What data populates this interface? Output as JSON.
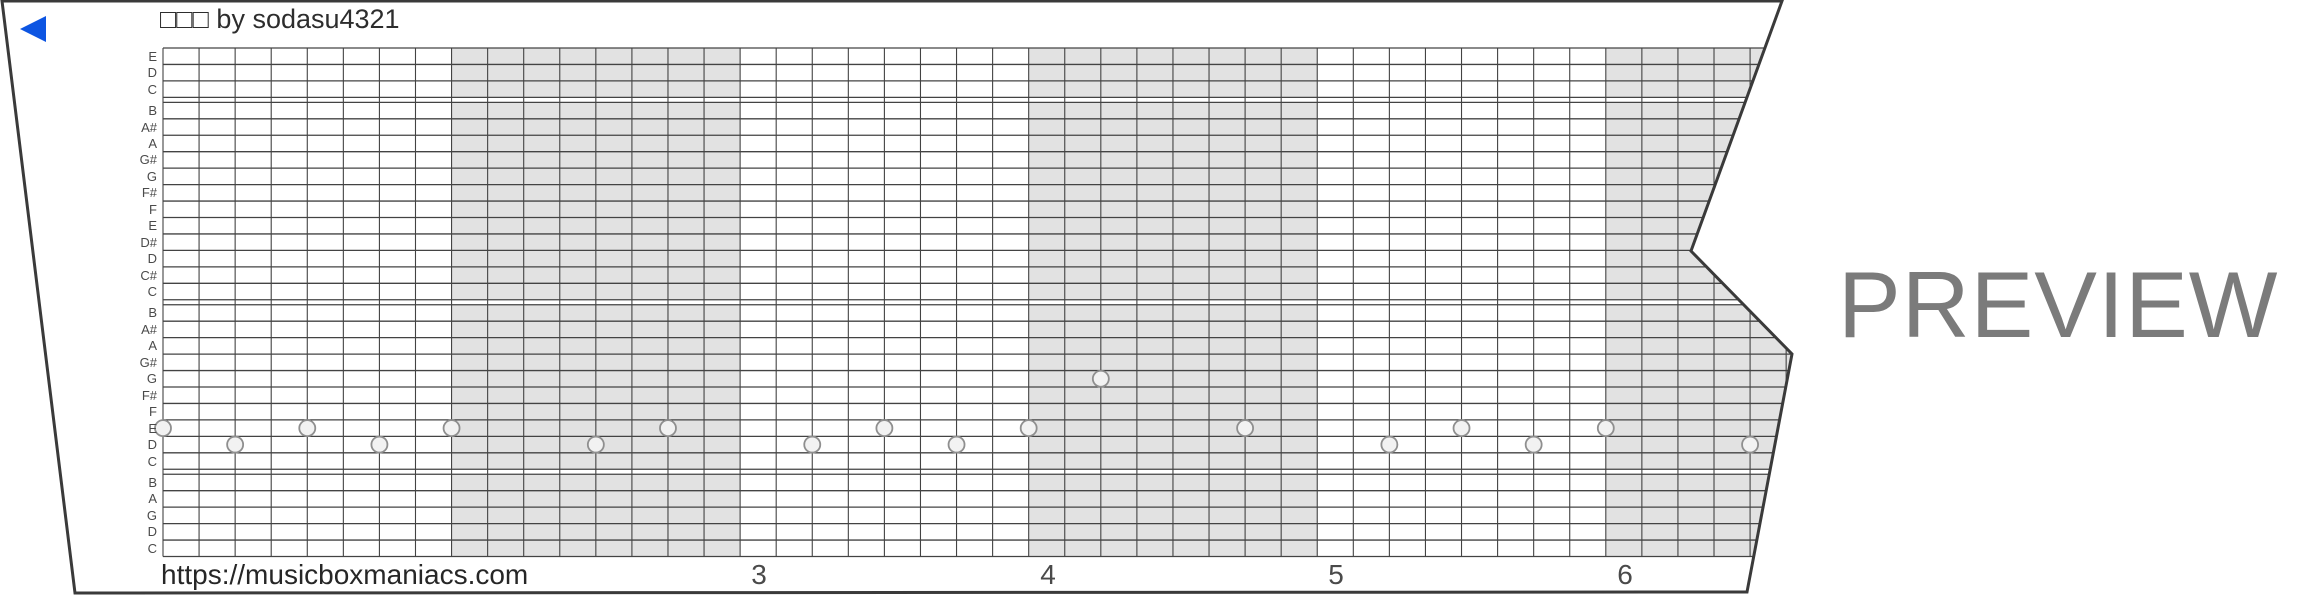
{
  "title": "□□□ by sodasu4321",
  "watermark": "PREVIEW",
  "footer_url": "https://musicboxmaniacs.com",
  "colors": {
    "paper_outline": "#3a3a3a",
    "grid_line": "#434343",
    "measure_shade": "#e2e2e2",
    "note_fill": "#f2f2f2",
    "note_stroke": "#8f8f8f",
    "play_arrow_blue": "#0d55e2",
    "watermark_gray": "#7b7b7b",
    "text_dark": "#2d2d2d",
    "text_muted": "#4a4a4a"
  },
  "chart_data": {
    "type": "piano-roll",
    "row_labels": [
      "E",
      "D",
      "C",
      "B",
      "A#",
      "A",
      "G#",
      "G",
      "F#",
      "F",
      "E",
      "D#",
      "D",
      "C#",
      "C",
      "B",
      "A#",
      "A",
      "G#",
      "G",
      "F#",
      "F",
      "E",
      "D",
      "C",
      "B",
      "A",
      "G",
      "D",
      "C"
    ],
    "row_groups": [
      3,
      12,
      10,
      5
    ],
    "columns_per_measure": 8,
    "shaded_measures": [
      1,
      3,
      5
    ],
    "measure_numbers": [
      {
        "label": "3",
        "x": 759
      },
      {
        "label": "4",
        "x": 1048
      },
      {
        "label": "5",
        "x": 1336
      },
      {
        "label": "6",
        "x": 1625
      }
    ],
    "notes": [
      {
        "col": 0,
        "row": 22,
        "pitch": "E"
      },
      {
        "col": 2,
        "row": 23,
        "pitch": "D"
      },
      {
        "col": 4,
        "row": 22,
        "pitch": "E"
      },
      {
        "col": 6,
        "row": 23,
        "pitch": "D"
      },
      {
        "col": 8,
        "row": 22,
        "pitch": "E"
      },
      {
        "col": 12,
        "row": 23,
        "pitch": "D"
      },
      {
        "col": 14,
        "row": 22,
        "pitch": "E"
      },
      {
        "col": 18,
        "row": 23,
        "pitch": "D"
      },
      {
        "col": 20,
        "row": 22,
        "pitch": "E"
      },
      {
        "col": 22,
        "row": 23,
        "pitch": "D"
      },
      {
        "col": 24,
        "row": 22,
        "pitch": "E"
      },
      {
        "col": 26,
        "row": 19,
        "pitch": "G"
      },
      {
        "col": 30,
        "row": 22,
        "pitch": "E"
      },
      {
        "col": 34,
        "row": 23,
        "pitch": "D"
      },
      {
        "col": 36,
        "row": 22,
        "pitch": "E"
      },
      {
        "col": 38,
        "row": 23,
        "pitch": "D"
      },
      {
        "col": 40,
        "row": 22,
        "pitch": "E"
      },
      {
        "col": 44,
        "row": 23,
        "pitch": "D"
      }
    ]
  }
}
